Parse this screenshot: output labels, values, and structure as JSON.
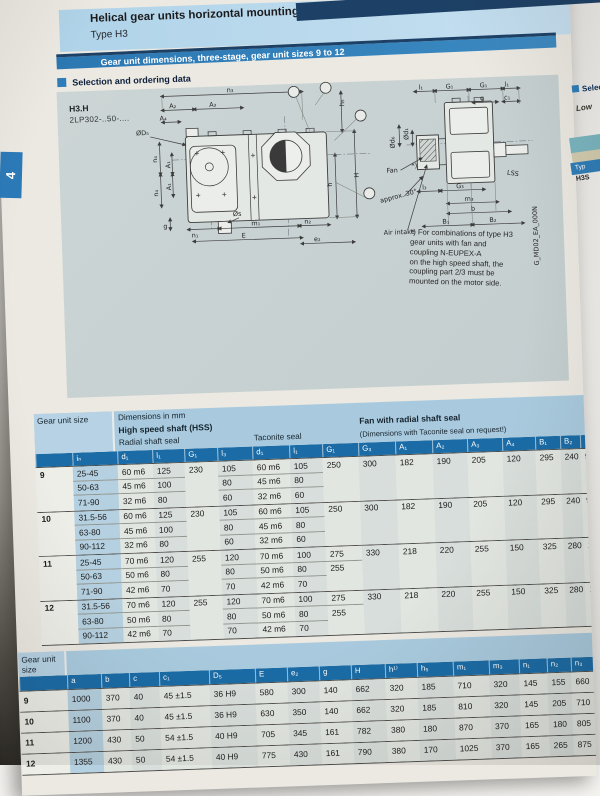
{
  "page": {
    "title": "Helical gear units horizontal mounting pos",
    "subtitle": "Type H3",
    "banner": "Gear unit dimensions, three-stage, gear unit sizes 9 to 12",
    "section": "Selection and ordering data",
    "side_tab": "4",
    "model": "H3.H",
    "order_code": "2LP302-..50-...."
  },
  "colors": {
    "banner_blue": "#2e7db8",
    "strip_blue": "#1a6ba6",
    "header_light_blue": "#a9cade",
    "panel_gray": "#c9d2d2",
    "tab_blue": "#2b7ab8"
  },
  "drawing": {
    "labels": {
      "n3": "n₃",
      "A1": "A₁",
      "A2": "A₂",
      "A3": "A₃",
      "A4": "A₄",
      "dD5": "ØD₅",
      "n4": "n₄",
      "g": "g",
      "n1": "n₁",
      "ds": "Øs",
      "m1": "m₁",
      "E": "E",
      "n2": "n₂",
      "e2": "e₂",
      "h5": "h₅",
      "H": "H",
      "h": "h",
      "l1": "l₁",
      "G1": "G₁",
      "c1": "c₁",
      "dd6": "Ød₆",
      "dd1": "Ød₁",
      "l3": "l₃",
      "G3": "G₃",
      "m3": "m₃",
      "b": "b",
      "B1": "B₁",
      "B2": "B₂",
      "fan": "Fan",
      "lss": "LSS",
      "approx": "approx. 30°",
      "air": "Air intake",
      "star": "*)",
      "code": "G_MD02_EA_000N"
    },
    "note_lines": [
      "*) For combinations of type H3",
      "gear units with fan and",
      "coupling N-EUPEX-A",
      "on the high speed shaft, the",
      "coupling part 2/3 must be",
      "mounted on the motor side."
    ]
  },
  "table1": {
    "corner": "Gear unit size",
    "dims_note": "Dimensions in mm",
    "group_hss": "High speed shaft (HSS)",
    "group_radial": "Radial shaft seal",
    "group_taconite": "Taconite seal",
    "group_fan": "Fan with radial shaft seal",
    "group_fan_sub": "(Dimensions with Taconite seal on request!)",
    "columns": [
      "iₙ",
      "d₁",
      "l₁",
      "G₁",
      "l₃",
      "d₁",
      "l₁",
      "G₁",
      "G₃",
      "A₁",
      "A₂",
      "A₃",
      "A₄",
      "B₁",
      "B₂"
    ],
    "groups": [
      {
        "size": "9",
        "stub": "90",
        "rows": [
          [
            "25-45",
            "60 m6",
            "125",
            "230",
            "105",
            "60 m6",
            "105",
            "250",
            "300",
            "182",
            "190",
            "205",
            "120",
            "295",
            "240"
          ],
          [
            "50-63",
            "45 m6",
            "100",
            "",
            "80",
            "45 m6",
            "80",
            "",
            "",
            "",
            "",
            "",
            "",
            "",
            ""
          ],
          [
            "71-90",
            "32 m6",
            "80",
            "",
            "60",
            "32 m6",
            "60",
            "",
            "",
            "",
            "",
            "",
            "",
            "",
            ""
          ]
        ]
      },
      {
        "size": "10",
        "stub": "90",
        "rows": [
          [
            "31.5-56",
            "60 m6",
            "125",
            "230",
            "105",
            "60 m6",
            "105",
            "250",
            "300",
            "182",
            "190",
            "205",
            "120",
            "295",
            "240"
          ],
          [
            "63-80",
            "45 m6",
            "100",
            "",
            "80",
            "45 m6",
            "80",
            "",
            "",
            "",
            "",
            "",
            "",
            "",
            ""
          ],
          [
            "90-112",
            "32 m6",
            "80",
            "",
            "60",
            "32 m6",
            "60",
            "",
            "",
            "",
            "",
            "",
            "",
            "",
            ""
          ]
        ]
      },
      {
        "size": "11",
        "stub": "100",
        "rows": [
          [
            "25-45",
            "70 m6",
            "120",
            "255",
            "120",
            "70 m6",
            "100",
            "275",
            "330",
            "218",
            "220",
            "255",
            "150",
            "325",
            "280"
          ],
          [
            "50-63",
            "50 m6",
            "80",
            "",
            "80",
            "50 m6",
            "80",
            "255",
            "",
            "",
            "",
            "",
            "",
            "",
            ""
          ],
          [
            "71-90",
            "42 m6",
            "70",
            "",
            "70",
            "42 m6",
            "70",
            "",
            "",
            "",
            "",
            "",
            "",
            "",
            ""
          ]
        ]
      },
      {
        "size": "12",
        "stub": "100",
        "rows": [
          [
            "31.5-56",
            "70 m6",
            "120",
            "255",
            "120",
            "70 m6",
            "100",
            "275",
            "330",
            "218",
            "220",
            "255",
            "150",
            "325",
            "280"
          ],
          [
            "63-80",
            "50 m6",
            "80",
            "",
            "80",
            "50 m6",
            "80",
            "255",
            "",
            "",
            "",
            "",
            "",
            "",
            ""
          ],
          [
            "90-112",
            "42 m6",
            "70",
            "",
            "70",
            "42 m6",
            "70",
            "",
            "",
            "",
            "",
            "",
            "",
            "",
            ""
          ]
        ]
      }
    ]
  },
  "table2": {
    "corner": "Gear unit size",
    "columns": [
      "a",
      "b",
      "c",
      "c₁",
      "D₅",
      "E",
      "e₂",
      "g",
      "H",
      "h¹⁾",
      "h₅",
      "m₁",
      "m₃",
      "n₁",
      "n₂",
      "n₃",
      "n₄"
    ],
    "rows": [
      {
        "size": "9",
        "values": [
          "1000",
          "370",
          "40",
          "45 ±1.5",
          "36 H9",
          "580",
          "300",
          "140",
          "662",
          "320",
          "185",
          "710",
          "320",
          "145",
          "155",
          "660",
          "245"
        ]
      },
      {
        "size": "10",
        "values": [
          "1100",
          "370",
          "40",
          "45 ±1.5",
          "36 H9",
          "630",
          "350",
          "140",
          "662",
          "320",
          "185",
          "810",
          "320",
          "145",
          "205",
          "710",
          "245"
        ]
      },
      {
        "size": "11",
        "values": [
          "1200",
          "430",
          "50",
          "54 ±1.5",
          "40 H9",
          "705",
          "345",
          "161",
          "782",
          "380",
          "180",
          "870",
          "370",
          "165",
          "180",
          "805",
          "300"
        ]
      },
      {
        "size": "12",
        "values": [
          "1355",
          "430",
          "50",
          "54 ±1.5",
          "40 H9",
          "775",
          "430",
          "161",
          "790",
          "380",
          "170",
          "1025",
          "370",
          "165",
          "265",
          "875",
          "300"
        ]
      }
    ]
  },
  "next_page": {
    "selec": "Selec",
    "low": "Low",
    "typ": "Typ",
    "h3s": "H3S"
  }
}
